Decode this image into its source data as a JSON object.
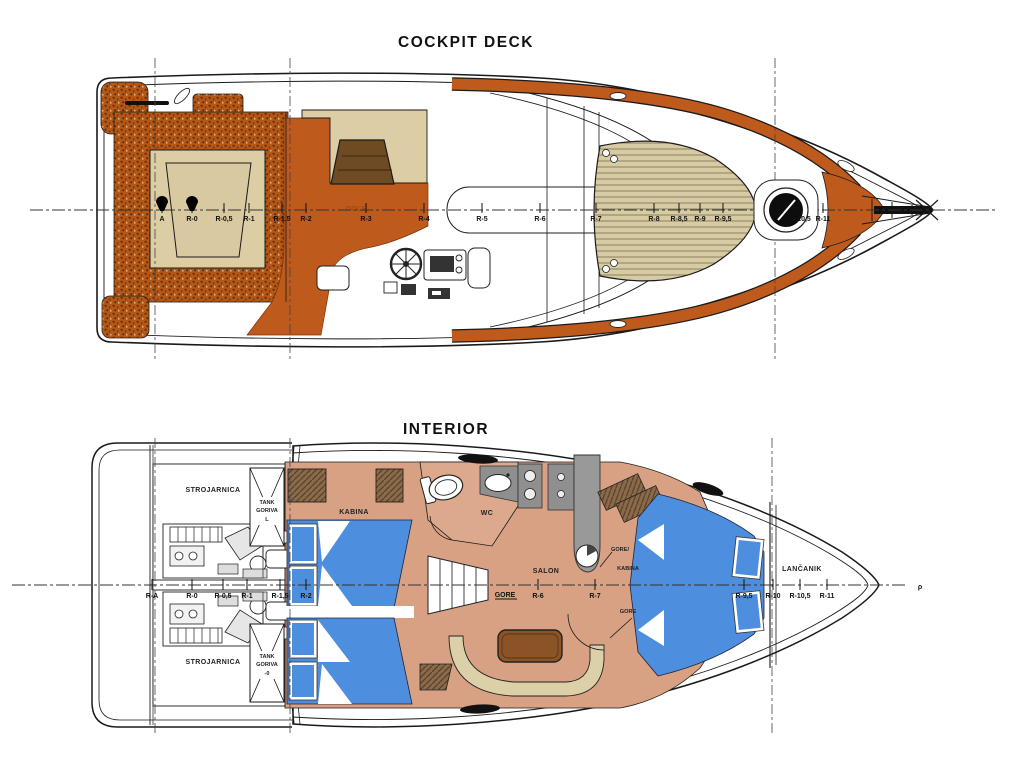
{
  "page": {
    "background": "#ffffff"
  },
  "cockpit": {
    "title": "COCKPIT DECK",
    "faint_label": "DOLE",
    "stations": [
      "A",
      "R-0",
      "R-0,5",
      "R-1",
      "R-1,5",
      "R-2",
      "R-3",
      "R-4",
      "R-5",
      "R-6",
      "R-7",
      "R-8",
      "R-8,5",
      "R-9",
      "R-9,5",
      "10,5",
      "R-11"
    ]
  },
  "interior": {
    "title": "INTERIOR",
    "centerline_end": "ρ",
    "stations": [
      "R-A",
      "R-0",
      "R-0,5",
      "R-1",
      "R-1,5",
      "R-2",
      "R-6",
      "R-7",
      "R-9,5",
      "R-10",
      "R-10,5",
      "R-11"
    ],
    "rooms": {
      "engine_room": "STROJARNICA",
      "tank_line1": "TANK",
      "tank_line2": "GORIVA",
      "tank_top_no": "L",
      "tank_bottom_no": "-0",
      "mid_cabin": "KABINA",
      "wc": "WC",
      "salon": "SALON",
      "up": "GORE",
      "up_slash": "GORE/",
      "fwd_cabin": "KABINA",
      "chain_locker": "LANČANIK"
    }
  },
  "colors": {
    "teak_orange": "#BF5A1D",
    "teak_speckle": "#B45717",
    "cushion_tan": "#DCCDA5",
    "wood_dark": "#6E4B22",
    "table_wood": "#8A5426",
    "floor_salmon": "#D9A183",
    "bed_blue": "#4E8EDE",
    "counter_gray": "#8F8F8F",
    "bench_beige": "#DCD0A8",
    "line_ink": "#1A1A1A"
  }
}
